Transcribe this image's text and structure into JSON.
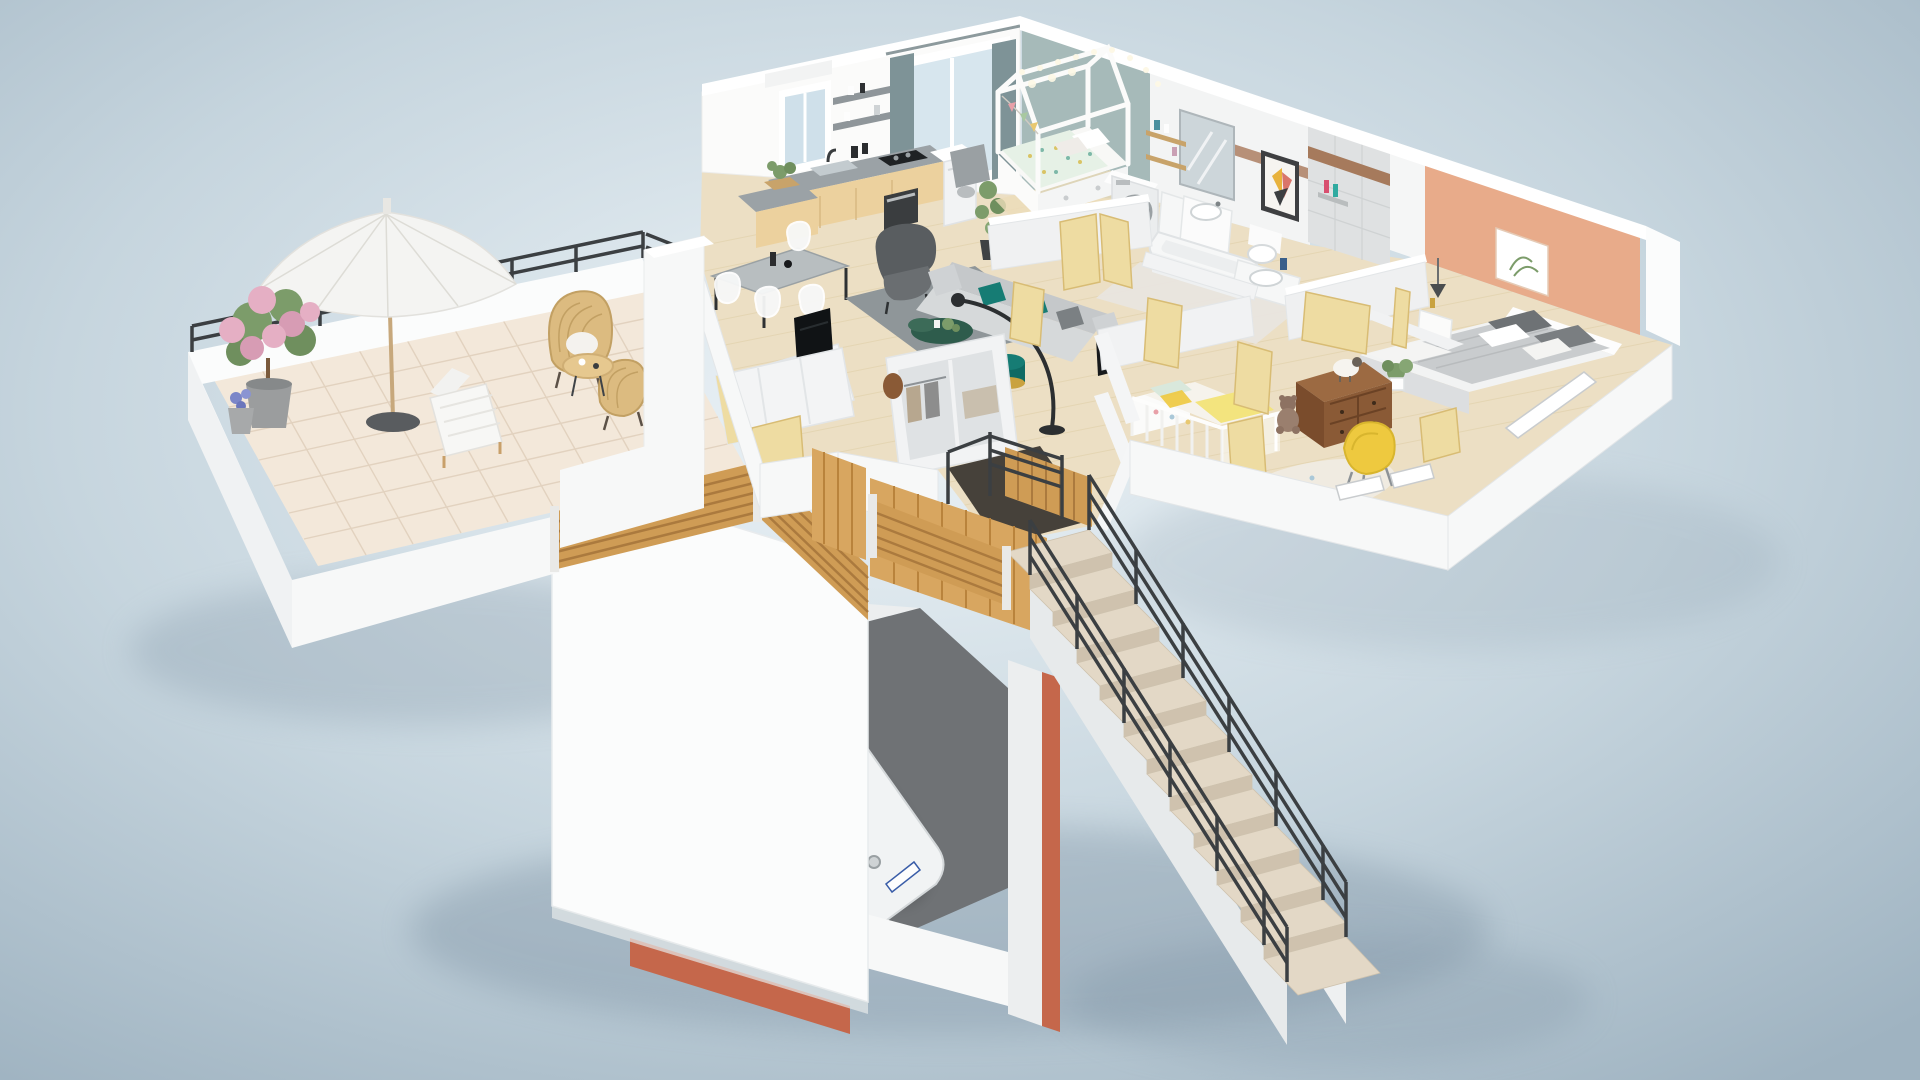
{
  "meta": {
    "description": "3D isometric cutaway rendering of a single-storey house floor plan with furnished rooms, a large tiled terrace with parasol, an exterior staircase and a basement garage containing a white car. No text or labels are rendered in the image.",
    "image_type": "architectural-3d-floor-plan-render"
  },
  "palette": {
    "bg_outer": "#9fb3c1",
    "bg_mid": "#c6d5de",
    "bg_center": "#ecf3f7",
    "wall_white": "#f7f8f8",
    "wall_shade": "#eceeef",
    "wall_dark": "#dfe2e4",
    "floor_wood": "#ecdfc4",
    "terrace_tile": "#f3e8da",
    "wood_slat": "#cf9c55",
    "door_pine": "#eedca2",
    "rail_black": "#3b3f42",
    "teal_wall": "#a6bab9",
    "peach_wall": "#e8ab8a",
    "terracotta": "#c5674b",
    "counter_gray": "#9ba2a6",
    "cabinet_wood": "#ecd19e",
    "sofa_gray": "#d6d9da",
    "rug_gray": "#8f9699",
    "teal_accent": "#167c74",
    "step_beige": "#e3d8c6",
    "step_riser": "#cfc2ae",
    "garage_floor": "#6f7275",
    "car_white": "#f1f3f4",
    "glass_dark": "#15181b",
    "plant_green": "#7c9c6a",
    "flower_pink": "#e5afc4",
    "accent_yellow": "#eec93f",
    "wood_brown": "#8a5a36"
  },
  "scene": {
    "rooms": [
      {
        "name": "terrace",
        "furniture": [
          "white-parasol",
          "flowering-shrub-in-pot",
          "small-flower-pot",
          "sun-lounger",
          "rattan-egg-chair",
          "rattan-chair",
          "round-side-table",
          "metal-guardrail",
          "wood-slat-fence"
        ]
      },
      {
        "name": "kitchen",
        "furniture": [
          "window",
          "wall-shelves",
          "sink-counter",
          "cooktop",
          "oven",
          "fridge",
          "kitchen-island",
          "plant"
        ]
      },
      {
        "name": "dining-area",
        "furniture": [
          "dining-table",
          "wire-chairs"
        ]
      },
      {
        "name": "living-room",
        "furniture": [
          "sofa",
          "teal-cushions",
          "armchair",
          "rug",
          "round-coffee-table",
          "teal-pouf",
          "tv",
          "tv-bench",
          "arc-floor-lamp",
          "speaker",
          "wardrobe",
          "entry-closet"
        ]
      },
      {
        "name": "kids-bedroom",
        "furniture": [
          "teal-accent-wall",
          "window-with-curtains",
          "house-frame-bed",
          "string-lights",
          "garland",
          "desk"
        ]
      },
      {
        "name": "laundry",
        "furniture": [
          "washing-machine",
          "cabinet"
        ]
      },
      {
        "name": "bathroom",
        "furniture": [
          "vanity-with-mirror",
          "wood-shelves",
          "bathtub",
          "toilet",
          "second-washbasin",
          "abstract-art-frame",
          "tiled-shower",
          "brown-tile-stripe"
        ]
      },
      {
        "name": "master-bedroom",
        "furniture": [
          "peach-accent-wall",
          "botanical-art-frame",
          "double-bed",
          "gray-pillows",
          "nightstand",
          "pendant-lamp",
          "plant"
        ]
      },
      {
        "name": "nursery",
        "furniture": [
          "crib",
          "yellow-blanket",
          "wood-dresser",
          "sheep-toy",
          "teddy-bear",
          "yellow-shell-chair",
          "rug"
        ]
      },
      {
        "name": "hallway",
        "furniture": [
          "pine-doors"
        ]
      },
      {
        "name": "garage",
        "furniture": [
          "white-car",
          "terracotta-accent-band",
          "wood-plank-wall-top"
        ]
      },
      {
        "name": "staircase",
        "furniture": [
          "stone-steps",
          "black-metal-railings",
          "wood-guard-fence"
        ]
      }
    ]
  }
}
